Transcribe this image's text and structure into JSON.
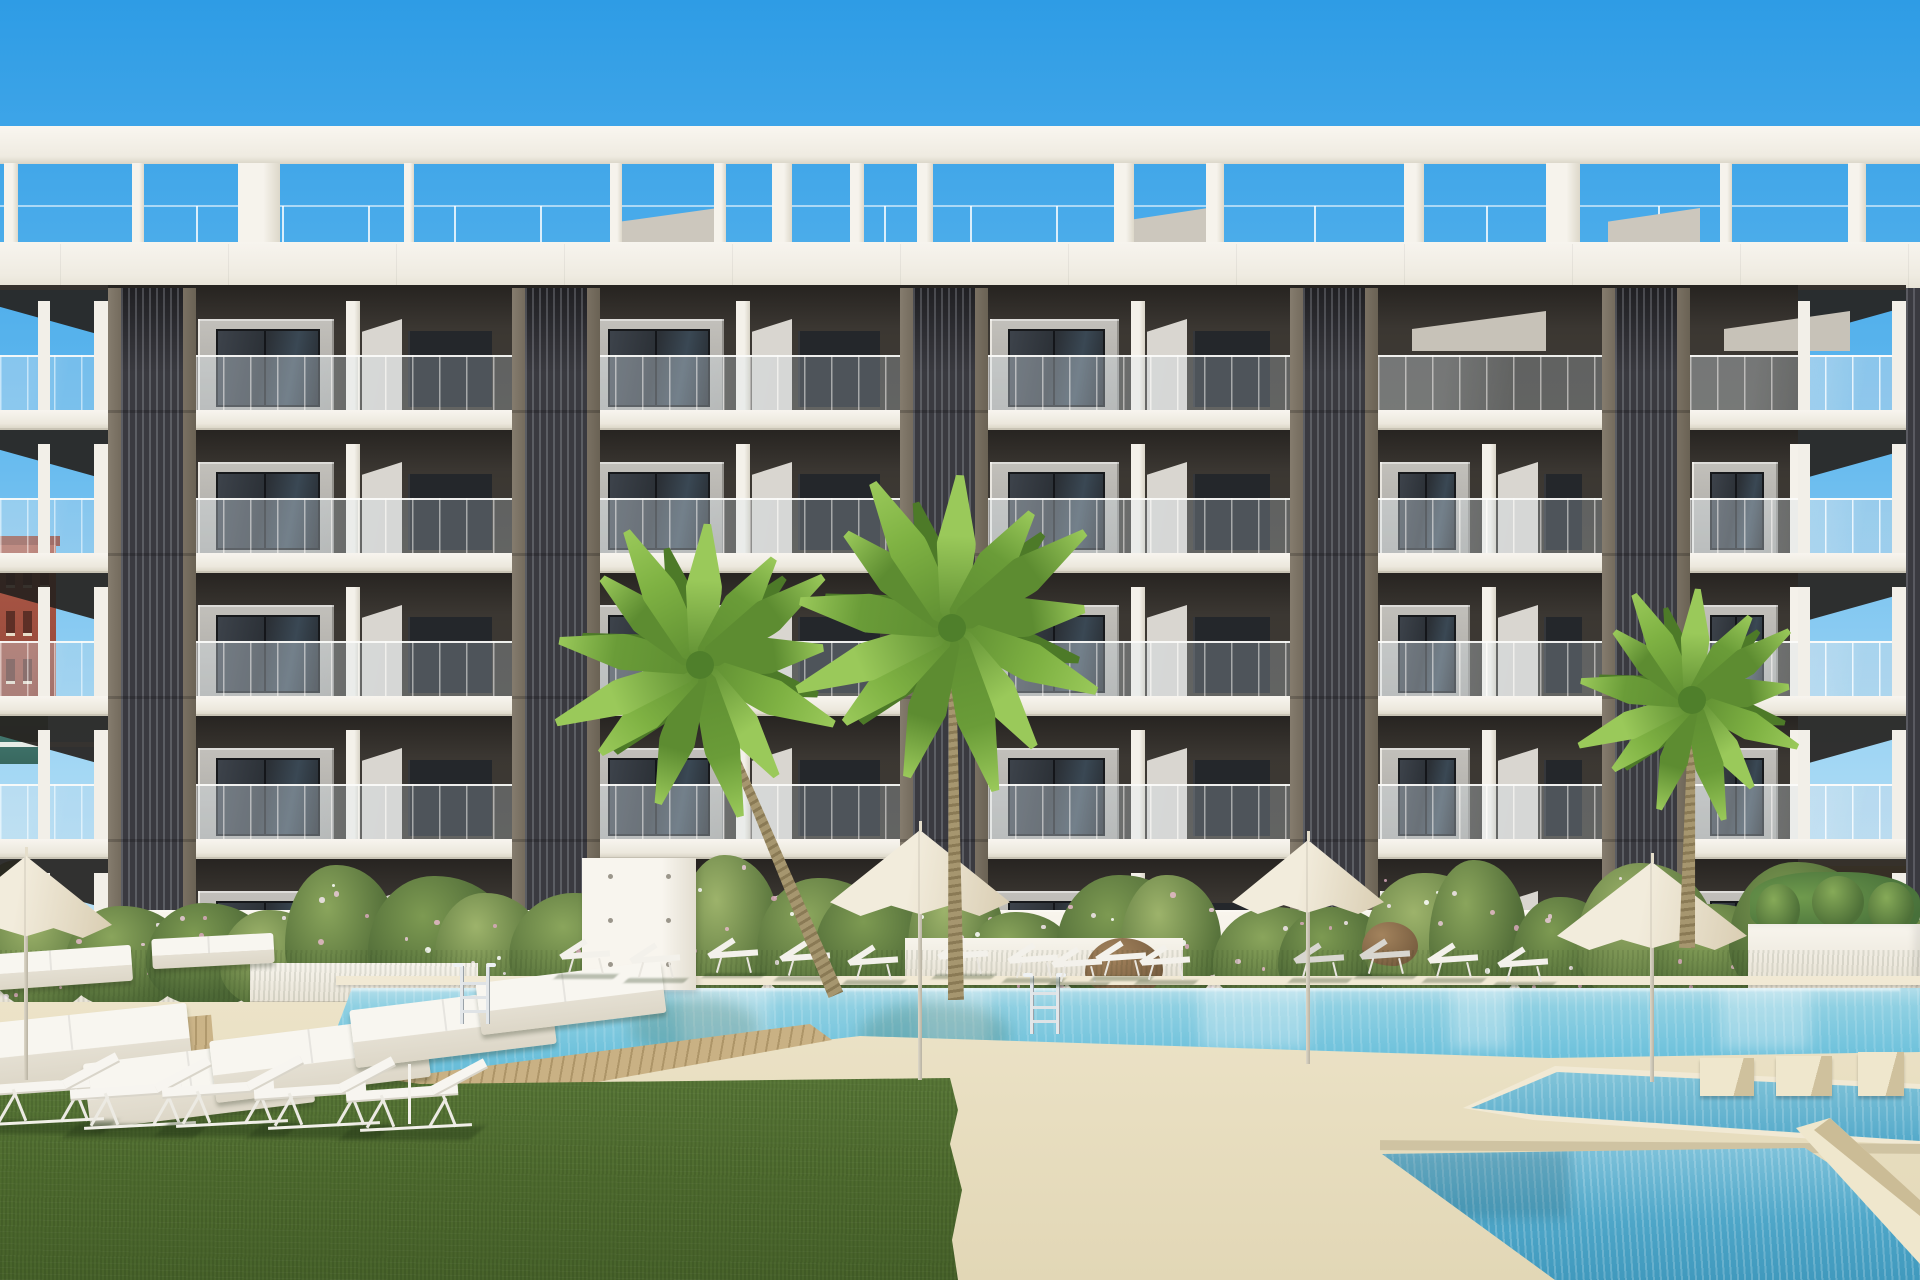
{
  "scene": {
    "title": "Architectural render: new-build apartment complex with communal pools, palm trees, sun loungers and parasols",
    "width": 1920,
    "height": 1280
  },
  "palette": {
    "sky_top": "#2e9ce5",
    "sky_mid": "#5fb7ee",
    "sky_low": "#a5d8f4",
    "sky_horizon": "#cfeafa",
    "white_hi": "#f7f4ee",
    "white": "#f2efe7",
    "white_shade": "#ddd8cb",
    "shadow_dark": "#262320",
    "shadow_mid": "#3b3732",
    "module_grey": "#bcbab5",
    "module_grey_dk": "#a9a7a2",
    "wedge": "#d9d6d0",
    "window_dark": "#2e3339",
    "window_frame": "#17191c",
    "deep_window": "#24272b",
    "slat": "#3a3a40",
    "slat_frame_lt": "#857c6e",
    "slat_frame_dk": "#6a6254",
    "glass": "rgba(203,220,232,0.25)",
    "rail": "#f9f9f6",
    "wall_white": "#f5f1e8",
    "grass": "#597739",
    "grass_dark": "#4a662c",
    "sand": "#e8dec0",
    "sand_light": "#efe7cd",
    "coping": "#f1e9d4",
    "water_light": "#c2e4ee",
    "water": "#6fc2dc",
    "water_deep": "#4ea6c8",
    "wood": "#c9b184",
    "wood_dark": "#ad9568",
    "leaf": "#7fb243",
    "leaf_dark": "#5d8c31",
    "leaf_light": "#9ac95a",
    "trunk": "#a6966f",
    "trunk_dark": "#8a7a55",
    "umbrella": "#f2ecdc",
    "umbrella_shade": "#d9cdb2",
    "bg_red": "#a34e3e",
    "bg_teal": "#4a837b",
    "bg_yellow": "#eac45f"
  },
  "pergola": {
    "beam": {
      "y": 126,
      "h": 38
    },
    "posts": [
      [
        4,
        14
      ],
      [
        132,
        12
      ],
      [
        238,
        42
      ],
      [
        404,
        10
      ],
      [
        610,
        12
      ],
      [
        714,
        12
      ],
      [
        772,
        20
      ],
      [
        850,
        14
      ],
      [
        917,
        16
      ],
      [
        1114,
        20
      ],
      [
        1206,
        18
      ],
      [
        1404,
        20
      ],
      [
        1546,
        34
      ],
      [
        1720,
        12
      ],
      [
        1848,
        18
      ]
    ],
    "bulkheads": [
      [
        620,
        98
      ],
      [
        1118,
        90
      ],
      [
        1608,
        92
      ]
    ],
    "fascia": {
      "y": 242,
      "h": 48
    }
  },
  "facade": {
    "floor_tops": [
      285,
      428,
      571,
      714,
      857
    ],
    "slab_h": 18,
    "columns": [
      108,
      512,
      900,
      1290,
      1602
    ],
    "col_w": 88,
    "col_top": 288,
    "col_bottom": 1002,
    "bays": [
      [
        196,
        316
      ],
      [
        588,
        312
      ],
      [
        988,
        302
      ],
      [
        1378,
        224
      ],
      [
        1690,
        216
      ]
    ],
    "edge_bays": [
      [
        0,
        108
      ],
      [
        1798,
        108
      ]
    ],
    "right_sliver": [
      1906,
      288,
      14,
      714
    ]
  },
  "background": {
    "left_roof": [
      0,
      536,
      60,
      10
    ],
    "left_red": [
      0,
      545,
      56,
      162
    ],
    "left_teal": [
      0,
      706,
      48,
      58
    ],
    "left_rail": [
      0,
      742,
      110,
      5
    ],
    "left_plants": [
      [
        -18,
        860,
        70,
        80
      ],
      [
        -10,
        920,
        76,
        90
      ]
    ],
    "right_roof": [
      1790,
      860,
      130,
      9
    ],
    "right_yellow": [
      1792,
      866,
      128,
      204
    ],
    "right_band": [
      1792,
      950,
      128,
      10
    ],
    "right_teal": [
      1800,
      984,
      52,
      16
    ]
  },
  "garden": {
    "wall": [
      0,
      910,
      1920,
      96
    ],
    "hedge_count": 26,
    "ledges": [
      [
        250,
        963,
        228,
        38
      ],
      [
        905,
        938,
        278,
        38
      ]
    ],
    "rocks": [
      [
        1085,
        938,
        78,
        58
      ],
      [
        1362,
        922,
        56,
        44
      ]
    ],
    "planter_box": [
      1748,
      924,
      172,
      90
    ],
    "monolith": [
      582,
      858,
      114,
      132
    ]
  },
  "terrain": {
    "grass_strip": [
      0,
      950,
      1920,
      58
    ],
    "deck": [
      0,
      1002,
      1920,
      278
    ],
    "lawn": [
      0,
      1040,
      968,
      240
    ]
  },
  "pools": {
    "main_box": [
      300,
      980,
      1620,
      132
    ],
    "coping": [
      336,
      976,
      1584,
      9
    ],
    "channel_box": [
      1455,
      1058,
      465,
      92
    ],
    "bottom_box": [
      1260,
      1148,
      660,
      132
    ],
    "bottom_coping": [
      1380,
      1142,
      548,
      10
    ],
    "wedge": [
      1788,
      1116,
      132,
      148
    ],
    "steps": [
      [
        1700,
        1058,
        54,
        38
      ],
      [
        1776,
        1056,
        56,
        40
      ],
      [
        1858,
        1052,
        46,
        44
      ]
    ],
    "ladders": [
      [
        460,
        966
      ],
      [
        1030,
        976
      ]
    ]
  },
  "wood_deck": {
    "main": [
      170,
      1016,
      672,
      138
    ],
    "left_patch": [
      0,
      1024,
      215,
      80
    ]
  },
  "furniture": {
    "umbrellas": [
      [
        26,
        856,
        172,
        82,
        150
      ],
      [
        920,
        830,
        180,
        86,
        172
      ],
      [
        1308,
        840,
        152,
        74,
        158
      ],
      [
        1652,
        862,
        190,
        88,
        140
      ]
    ],
    "loungers_row": [
      [
        552,
        934
      ],
      [
        622,
        938
      ],
      [
        700,
        933
      ],
      [
        772,
        936
      ],
      [
        840,
        940
      ],
      [
        930,
        934
      ],
      [
        1000,
        938
      ],
      [
        1044,
        942
      ],
      [
        1088,
        936
      ],
      [
        1132,
        940
      ],
      [
        1286,
        938
      ],
      [
        1352,
        934
      ],
      [
        1420,
        938
      ],
      [
        1490,
        942
      ]
    ],
    "grey_seat_indexes": [
      10,
      11
    ],
    "mattresses": [
      [
        -30,
        1014,
        220,
        64,
        -6
      ],
      [
        86,
        1050,
        226,
        66,
        -7
      ],
      [
        212,
        1028,
        216,
        62,
        -7
      ],
      [
        352,
        998,
        202,
        58,
        -7
      ],
      [
        478,
        972,
        186,
        52,
        -7
      ],
      [
        -20,
        950,
        152,
        36,
        -4
      ],
      [
        152,
        936,
        122,
        30,
        -3
      ]
    ],
    "fg_loungers": [
      [
        -28,
        1056
      ],
      [
        64,
        1060
      ],
      [
        156,
        1058
      ],
      [
        248,
        1060
      ],
      [
        340,
        1062
      ]
    ],
    "pole": [
      408,
      1064,
      3,
      60
    ]
  },
  "palms": [
    {
      "cx": 700,
      "cy": 665,
      "r": 152,
      "bx": 836,
      "by": 995
    },
    {
      "cx": 952,
      "cy": 628,
      "r": 164,
      "bx": 956,
      "by": 1000
    },
    {
      "cx": 1692,
      "cy": 700,
      "r": 120,
      "bx": 1687,
      "by": 948
    }
  ]
}
